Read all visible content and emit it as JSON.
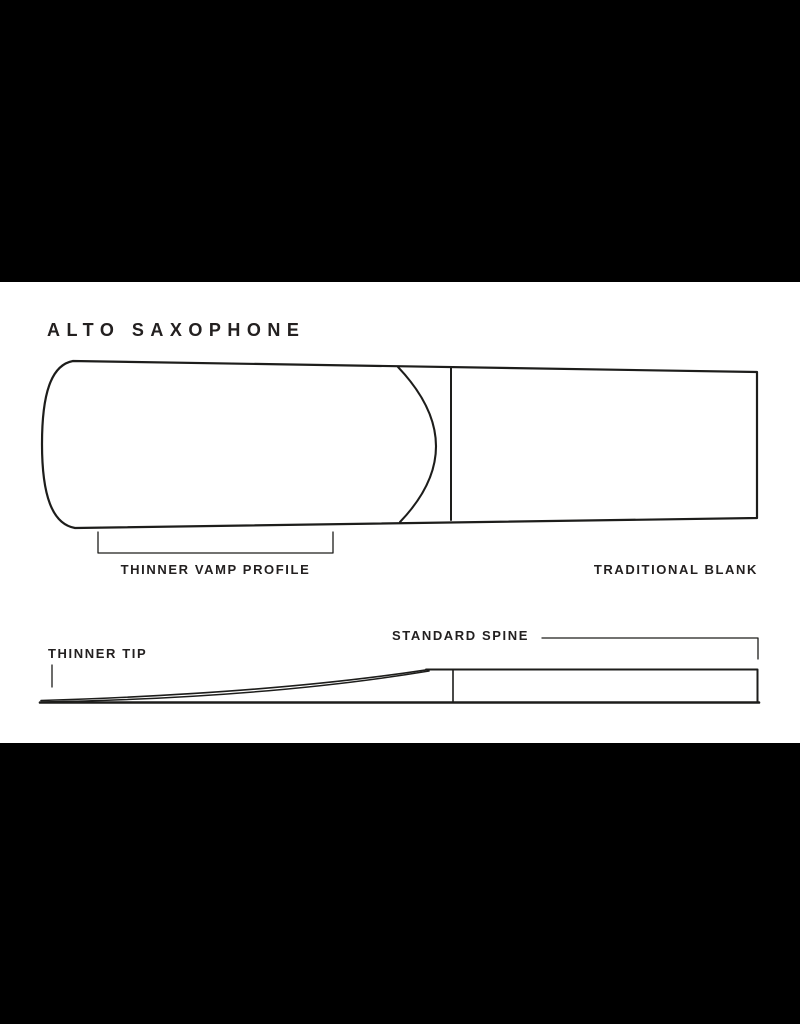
{
  "title": "ALTO SAXOPHONE",
  "diagram": {
    "labels": {
      "vamp": "THINNER VAMP PROFILE",
      "blank": "TRADITIONAL BLANK",
      "spine": "STANDARD SPINE",
      "tip": "THINNER TIP"
    },
    "views": {
      "top_view": "reed top view with vamp arc and blank divider",
      "side_view": "reed side profile with tapered tip and standard spine"
    }
  },
  "colors": {
    "letterbox": "#000000",
    "canvas": "#ffffff",
    "line": "#1d1d1b",
    "text": "#232020"
  }
}
